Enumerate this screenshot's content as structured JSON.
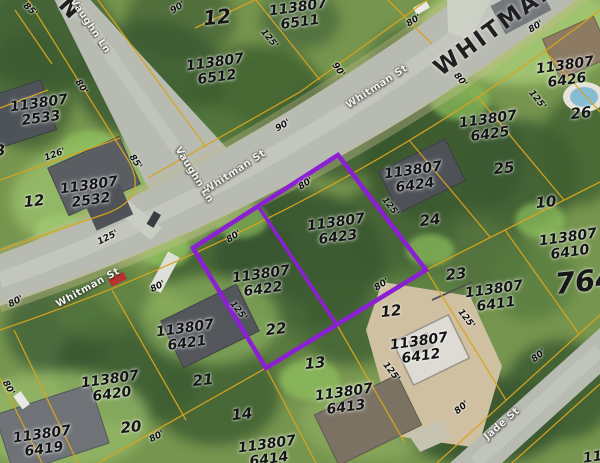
{
  "map": {
    "highlighted_parcels": [
      "113807 6422",
      "113807 6423"
    ],
    "colors": {
      "highlight": "#8b1fd4",
      "parcel_lines": "#d8a41e",
      "road": "#b7bbb1",
      "vegetation": "#76954e"
    },
    "labels": {
      "parcels": [
        {
          "pid": "113807",
          "num": "6511",
          "x": 299,
          "y": 15
        },
        {
          "pid": "113807",
          "num": "6512",
          "x": 216,
          "y": 70
        },
        {
          "pid": "113807",
          "num": "2533",
          "x": 40,
          "y": 111
        },
        {
          "pid": "113807",
          "num": "2532",
          "x": 90,
          "y": 193
        },
        {
          "pid": "113807",
          "num": "6426",
          "x": 566,
          "y": 73
        },
        {
          "pid": "113807",
          "num": "6425",
          "x": 489,
          "y": 127
        },
        {
          "pid": "113807",
          "num": "6424",
          "x": 414,
          "y": 178
        },
        {
          "pid": "113807",
          "num": "6423",
          "x": 337,
          "y": 230
        },
        {
          "pid": "113807",
          "num": "6422",
          "x": 262,
          "y": 282
        },
        {
          "pid": "113807",
          "num": "6421",
          "x": 186,
          "y": 336
        },
        {
          "pid": "113807",
          "num": "6420",
          "x": 111,
          "y": 387
        },
        {
          "pid": "113807",
          "num": "6419",
          "x": 43,
          "y": 442
        },
        {
          "pid": "113807",
          "num": "6413",
          "x": 345,
          "y": 400
        },
        {
          "pid": "113807",
          "num": "6412",
          "x": 420,
          "y": 349
        },
        {
          "pid": "113807",
          "num": "6411",
          "x": 495,
          "y": 297
        },
        {
          "pid": "113807",
          "num": "6410",
          "x": 569,
          "y": 245
        },
        {
          "pid": "113807",
          "num": "6414",
          "x": 268,
          "y": 452
        },
        {
          "pid": "113807",
          "num": "",
          "x": 612,
          "y": 455
        }
      ],
      "lots": [
        {
          "t": "12",
          "x": 217,
          "y": 17,
          "fs": 20
        },
        {
          "t": "26",
          "x": 581,
          "y": 113
        },
        {
          "t": "25",
          "x": 504,
          "y": 168
        },
        {
          "t": "24",
          "x": 430,
          "y": 220
        },
        {
          "t": "23",
          "x": 456,
          "y": 274
        },
        {
          "t": "22",
          "x": 276,
          "y": 329
        },
        {
          "t": "21",
          "x": 203,
          "y": 380
        },
        {
          "t": "20",
          "x": 131,
          "y": 427
        },
        {
          "t": "14",
          "x": 242,
          "y": 414
        },
        {
          "t": "13",
          "x": 315,
          "y": 363
        },
        {
          "t": "12",
          "x": 391,
          "y": 311
        },
        {
          "t": "10",
          "x": 546,
          "y": 202
        },
        {
          "t": "12",
          "x": 34,
          "y": 201
        },
        {
          "t": "13",
          "x": -5,
          "y": 151
        },
        {
          "t": "764",
          "x": 585,
          "y": 281,
          "fs": 29
        }
      ],
      "dims": [
        {
          "t": "85'",
          "x": 30,
          "y": 10,
          "r": 42
        },
        {
          "t": "90'",
          "x": 178,
          "y": 8,
          "r": -32
        },
        {
          "t": "125'",
          "x": 269,
          "y": 39,
          "r": 51
        },
        {
          "t": "90'",
          "x": 338,
          "y": 70,
          "r": 55
        },
        {
          "t": "80'",
          "x": 414,
          "y": 21,
          "r": -32
        },
        {
          "t": "80'",
          "x": 536,
          "y": 27,
          "r": -32
        },
        {
          "t": "80'",
          "x": 460,
          "y": 80,
          "r": 51
        },
        {
          "t": "125'",
          "x": 537,
          "y": 100,
          "r": 51
        },
        {
          "t": "80'",
          "x": 81,
          "y": 87,
          "r": 56
        },
        {
          "t": "126'",
          "x": 55,
          "y": 155,
          "r": -21
        },
        {
          "t": "85'",
          "x": 135,
          "y": 162,
          "r": 56
        },
        {
          "t": "90'",
          "x": 283,
          "y": 126,
          "r": -30
        },
        {
          "t": "80'",
          "x": 306,
          "y": 184,
          "r": -33
        },
        {
          "t": "125'",
          "x": 390,
          "y": 207,
          "r": 52
        },
        {
          "t": "80'",
          "x": 234,
          "y": 237,
          "r": -33
        },
        {
          "t": "125'",
          "x": 108,
          "y": 238,
          "r": -27
        },
        {
          "t": "80'",
          "x": 158,
          "y": 287,
          "r": -27
        },
        {
          "t": "80'",
          "x": 16,
          "y": 302,
          "r": -27
        },
        {
          "t": "125'",
          "x": 238,
          "y": 311,
          "r": 52
        },
        {
          "t": "80'",
          "x": 382,
          "y": 285,
          "r": -33
        },
        {
          "t": "125'",
          "x": 466,
          "y": 319,
          "r": 52
        },
        {
          "t": "80'",
          "x": 8,
          "y": 388,
          "r": 60
        },
        {
          "t": "125'",
          "x": 391,
          "y": 372,
          "r": 52
        },
        {
          "t": "80'",
          "x": 157,
          "y": 437,
          "r": -27
        },
        {
          "t": "80'",
          "x": 539,
          "y": 356,
          "r": -40
        },
        {
          "t": "80'",
          "x": 462,
          "y": 408,
          "r": -40
        }
      ],
      "streets": [
        {
          "t": "WHITMAN",
          "x": 496,
          "y": 28,
          "r": -36,
          "big": true
        },
        {
          "t": "N",
          "x": 70,
          "y": 9,
          "r": 48,
          "big": true
        },
        {
          "t": "Whitman St",
          "x": 88,
          "y": 288,
          "r": -29
        },
        {
          "t": "Whitman St",
          "x": 235,
          "y": 172,
          "r": -33
        },
        {
          "t": "Whitman St",
          "x": 377,
          "y": 87,
          "r": -33
        },
        {
          "t": "Vaughn Ln",
          "x": 90,
          "y": 26,
          "r": 56
        },
        {
          "t": "Vaughn Ln",
          "x": 194,
          "y": 175,
          "r": 58
        },
        {
          "t": "Jade St",
          "x": 502,
          "y": 424,
          "r": -41
        }
      ]
    }
  }
}
